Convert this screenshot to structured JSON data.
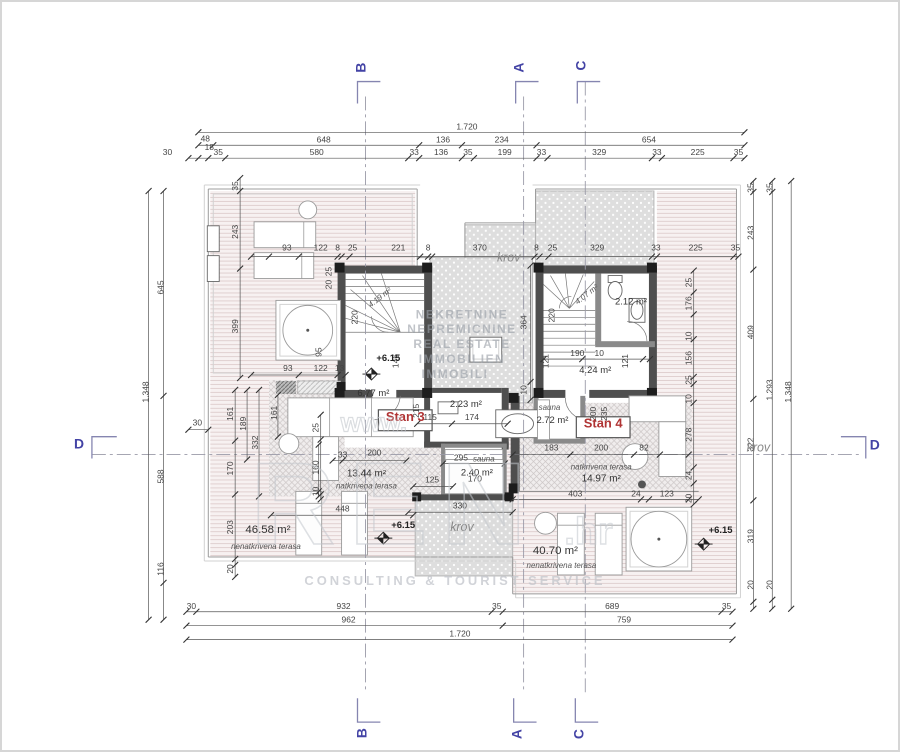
{
  "watermark": {
    "lines": [
      "NEKRETNINE",
      "NEPREMICNINE",
      "REAL ESTATE",
      "IMMOBILIEN",
      "IMMOBILI"
    ],
    "www": "www.",
    "big": "REN",
    "tld": ".hr",
    "tagline": "CONSULTING & TOURIST SERVICE"
  },
  "colors": {
    "section_letter": "#4343a5",
    "stan_label": "#b03434",
    "wall": "#4f4f4f",
    "terrace_stripe_bg": "#f7f1f1",
    "krov_fill": "#dcdcdc"
  },
  "section_markers": [
    {
      "l": "B",
      "x": 365,
      "y": 66,
      "h": 0
    },
    {
      "l": "A",
      "x": 524,
      "y": 66,
      "h": 0
    },
    {
      "l": "C",
      "x": 586,
      "y": 64,
      "h": 0
    },
    {
      "l": "B",
      "x": 366,
      "y": 735,
      "h": 0
    },
    {
      "l": "A",
      "x": 522,
      "y": 736,
      "h": 0
    },
    {
      "l": "C",
      "x": 584,
      "y": 736,
      "h": 0
    },
    {
      "l": "D",
      "x": 77,
      "y": 449,
      "h": 1
    },
    {
      "l": "D",
      "x": 877,
      "y": 450,
      "h": 1
    }
  ],
  "dim_chains": [
    {
      "o": "h",
      "p": 131,
      "a": 197,
      "b": 746,
      "t": [
        197,
        746
      ]
    },
    {
      "o": "h",
      "p": 144,
      "a": 197,
      "b": 746,
      "t": [
        197,
        212,
        419,
        462,
        537,
        746
      ]
    },
    {
      "o": "h",
      "p": 157,
      "a": 187,
      "b": 746,
      "t": [
        187,
        197,
        207,
        224,
        408,
        419,
        462,
        474,
        537,
        548,
        653,
        663,
        735,
        746
      ]
    },
    {
      "o": "h",
      "p": 256,
      "a": 250,
      "b": 740,
      "t": [
        250,
        268,
        298,
        337,
        341,
        349,
        420,
        428,
        432,
        535,
        540,
        549,
        653,
        658,
        735,
        740
      ]
    },
    {
      "o": "h",
      "p": 375,
      "a": 250,
      "b": 345,
      "t": [
        250,
        298,
        337,
        345
      ]
    },
    {
      "o": "h",
      "p": 424,
      "a": 417,
      "b": 508,
      "t": [
        417,
        452,
        508
      ]
    },
    {
      "o": "h",
      "p": 461,
      "a": 332,
      "b": 406,
      "t": [
        332,
        342,
        406
      ]
    },
    {
      "o": "h",
      "p": 464,
      "a": 443,
      "b": 505,
      "t": [
        443,
        505
      ]
    },
    {
      "o": "h",
      "p": 487,
      "a": 413,
      "b": 453,
      "t": [
        413,
        453
      ]
    },
    {
      "o": "h",
      "p": 513,
      "a": 408,
      "b": 513,
      "t": [
        408,
        513
      ]
    },
    {
      "o": "h",
      "p": 516,
      "a": 270,
      "b": 413,
      "t": [
        270,
        413
      ]
    },
    {
      "o": "h",
      "p": 455,
      "a": 513,
      "b": 690,
      "t": [
        513,
        571,
        635,
        661,
        690
      ]
    },
    {
      "o": "h",
      "p": 500,
      "a": 513,
      "b": 700,
      "t": [
        513,
        642,
        650,
        690,
        700
      ]
    },
    {
      "o": "h",
      "p": 359,
      "a": 544,
      "b": 651,
      "t": [
        544,
        583,
        644,
        651
      ]
    },
    {
      "o": "h",
      "p": 613,
      "a": 185,
      "b": 734,
      "t": [
        185,
        195,
        492,
        503,
        723,
        734
      ]
    },
    {
      "o": "h",
      "p": 627,
      "a": 185,
      "b": 734,
      "t": [
        185,
        503,
        734
      ]
    },
    {
      "o": "h",
      "p": 641,
      "a": 185,
      "b": 734,
      "t": [
        185,
        734
      ]
    },
    {
      "o": "h",
      "p": 430,
      "a": 187,
      "b": 207,
      "t": [
        187,
        207
      ]
    },
    {
      "o": "v",
      "p": 147,
      "a": 190,
      "b": 621,
      "t": [
        190,
        621
      ]
    },
    {
      "o": "v",
      "p": 162,
      "a": 190,
      "b": 621,
      "t": [
        190,
        396,
        584,
        621
      ]
    },
    {
      "o": "v",
      "p": 239,
      "a": 177,
      "b": 378,
      "t": [
        177,
        190,
        268,
        378
      ]
    },
    {
      "o": "v",
      "p": 234,
      "a": 390,
      "b": 578,
      "t": [
        390,
        441,
        495,
        560,
        566,
        578
      ]
    },
    {
      "o": "v",
      "p": 246,
      "a": 390,
      "b": 460,
      "t": [
        390,
        460
      ]
    },
    {
      "o": "v",
      "p": 258,
      "a": 390,
      "b": 497,
      "t": [
        390,
        497
      ]
    },
    {
      "o": "v",
      "p": 320,
      "a": 415,
      "b": 500,
      "t": [
        415,
        440,
        495,
        500
      ]
    },
    {
      "o": "v",
      "p": 755,
      "a": 180,
      "b": 610,
      "t": [
        180,
        191,
        269,
        399,
        501,
        603,
        610
      ]
    },
    {
      "o": "v",
      "p": 774,
      "a": 180,
      "b": 610,
      "t": [
        180,
        191,
        601,
        610
      ]
    },
    {
      "o": "v",
      "p": 793,
      "a": 180,
      "b": 610,
      "t": [
        180,
        610
      ]
    },
    {
      "o": "v",
      "p": 531,
      "a": 265,
      "b": 400,
      "t": [
        265,
        382,
        400
      ]
    },
    {
      "o": "v",
      "p": 695,
      "a": 270,
      "b": 505,
      "t": [
        270,
        292,
        314,
        339,
        377,
        384,
        403,
        468,
        484,
        505
      ]
    },
    {
      "o": "v",
      "p": 277,
      "a": 395,
      "b": 437,
      "t": [
        395,
        437
      ]
    },
    {
      "o": "v",
      "p": 318,
      "a": 445,
      "b": 497,
      "t": [
        445,
        492,
        497
      ]
    }
  ],
  "dim_labels": [
    {
      "t": "1.720",
      "x": 467,
      "y": 128
    },
    {
      "t": "48",
      "x": 204,
      "y": 140
    },
    {
      "t": "18",
      "x": 208,
      "y": 149
    },
    {
      "t": "648",
      "x": 323,
      "y": 141
    },
    {
      "t": "136",
      "x": 443,
      "y": 141
    },
    {
      "t": "234",
      "x": 502,
      "y": 141
    },
    {
      "t": "654",
      "x": 650,
      "y": 141
    },
    {
      "t": "30",
      "x": 166,
      "y": 154
    },
    {
      "t": "35",
      "x": 217,
      "y": 154
    },
    {
      "t": "580",
      "x": 316,
      "y": 154
    },
    {
      "t": "33",
      "x": 414,
      "y": 154
    },
    {
      "t": "136",
      "x": 441,
      "y": 154
    },
    {
      "t": "35",
      "x": 468,
      "y": 154
    },
    {
      "t": "199",
      "x": 505,
      "y": 154
    },
    {
      "t": "33",
      "x": 542,
      "y": 154
    },
    {
      "t": "329",
      "x": 600,
      "y": 154
    },
    {
      "t": "33",
      "x": 658,
      "y": 154
    },
    {
      "t": "225",
      "x": 699,
      "y": 154
    },
    {
      "t": "35",
      "x": 740,
      "y": 154
    },
    {
      "t": "1.348",
      "x": 147,
      "y": 392,
      "r": -90
    },
    {
      "t": "645",
      "x": 162,
      "y": 287,
      "r": -90
    },
    {
      "t": "588",
      "x": 162,
      "y": 477,
      "r": -90
    },
    {
      "t": "116",
      "x": 162,
      "y": 570,
      "r": -90
    },
    {
      "t": "30",
      "x": 196,
      "y": 426
    },
    {
      "t": "35",
      "x": 755,
      "y": 187,
      "r": -90
    },
    {
      "t": "243",
      "x": 755,
      "y": 232,
      "r": -90
    },
    {
      "t": "409",
      "x": 755,
      "y": 332,
      "r": -90
    },
    {
      "t": "322",
      "x": 755,
      "y": 445,
      "r": -90
    },
    {
      "t": "319",
      "x": 755,
      "y": 537,
      "r": -90
    },
    {
      "t": "20",
      "x": 755,
      "y": 586,
      "r": -90
    },
    {
      "t": "35",
      "x": 774,
      "y": 187,
      "r": -90
    },
    {
      "t": "1.293",
      "x": 774,
      "y": 390,
      "r": -90
    },
    {
      "t": "20",
      "x": 774,
      "y": 586,
      "r": -90
    },
    {
      "t": "1.348",
      "x": 793,
      "y": 392,
      "r": -90
    },
    {
      "t": "30",
      "x": 190,
      "y": 610
    },
    {
      "t": "932",
      "x": 343,
      "y": 610
    },
    {
      "t": "35",
      "x": 497,
      "y": 610
    },
    {
      "t": "689",
      "x": 613,
      "y": 610
    },
    {
      "t": "35",
      "x": 728,
      "y": 610
    },
    {
      "t": "962",
      "x": 348,
      "y": 624
    },
    {
      "t": "759",
      "x": 625,
      "y": 624
    },
    {
      "t": "1.720",
      "x": 460,
      "y": 638
    },
    {
      "t": "93",
      "x": 286,
      "y": 250
    },
    {
      "t": "122",
      "x": 320,
      "y": 250
    },
    {
      "t": "8",
      "x": 337,
      "y": 250
    },
    {
      "t": "25",
      "x": 352,
      "y": 250
    },
    {
      "t": "221",
      "x": 398,
      "y": 250
    },
    {
      "t": "8",
      "x": 428,
      "y": 250
    },
    {
      "t": "370",
      "x": 480,
      "y": 250
    },
    {
      "t": "8",
      "x": 537,
      "y": 250
    },
    {
      "t": "25",
      "x": 553,
      "y": 250
    },
    {
      "t": "329",
      "x": 598,
      "y": 250
    },
    {
      "t": "33",
      "x": 657,
      "y": 250
    },
    {
      "t": "225",
      "x": 697,
      "y": 250
    },
    {
      "t": "35",
      "x": 737,
      "y": 250
    },
    {
      "t": "93",
      "x": 287,
      "y": 371
    },
    {
      "t": "122",
      "x": 320,
      "y": 371
    },
    {
      "t": "13",
      "x": 339,
      "y": 371
    },
    {
      "t": "35",
      "x": 237,
      "y": 185,
      "r": -90
    },
    {
      "t": "243",
      "x": 237,
      "y": 231,
      "r": -90
    },
    {
      "t": "399",
      "x": 237,
      "y": 326,
      "r": -90
    },
    {
      "t": "25",
      "x": 331,
      "y": 271,
      "r": -90
    },
    {
      "t": "20",
      "x": 331,
      "y": 284,
      "r": -90
    },
    {
      "t": "95",
      "x": 321,
      "y": 352,
      "r": -90
    },
    {
      "t": "161",
      "x": 232,
      "y": 414,
      "r": -90
    },
    {
      "t": "189",
      "x": 245,
      "y": 424,
      "r": -90
    },
    {
      "t": "332",
      "x": 257,
      "y": 443,
      "r": -90
    },
    {
      "t": "170",
      "x": 232,
      "y": 469,
      "r": -90
    },
    {
      "t": "203",
      "x": 232,
      "y": 528,
      "r": -90
    },
    {
      "t": "20",
      "x": 232,
      "y": 570,
      "r": -90
    },
    {
      "t": "161",
      "x": 276,
      "y": 413,
      "r": -90
    },
    {
      "t": "25",
      "x": 318,
      "y": 428,
      "r": -90
    },
    {
      "t": "160",
      "x": 318,
      "y": 468,
      "r": -90
    },
    {
      "t": "10",
      "x": 318,
      "y": 492,
      "r": -90
    },
    {
      "t": "448",
      "x": 342,
      "y": 512
    },
    {
      "t": "33",
      "x": 342,
      "y": 458
    },
    {
      "t": "200",
      "x": 374,
      "y": 456
    },
    {
      "t": "125",
      "x": 432,
      "y": 483
    },
    {
      "t": "330",
      "x": 460,
      "y": 509
    },
    {
      "t": "295",
      "x": 461,
      "y": 461
    },
    {
      "t": "170",
      "x": 475,
      "y": 482
    },
    {
      "t": "115",
      "x": 430,
      "y": 420
    },
    {
      "t": "174",
      "x": 472,
      "y": 420
    },
    {
      "t": "215",
      "x": 419,
      "y": 411,
      "r": -90
    },
    {
      "t": "220",
      "x": 357,
      "y": 317,
      "r": -90
    },
    {
      "t": "146",
      "x": 398,
      "y": 361,
      "r": -90
    },
    {
      "t": "364",
      "x": 527,
      "y": 322,
      "r": -90
    },
    {
      "t": "10",
      "x": 527,
      "y": 390,
      "r": -90
    },
    {
      "t": "220",
      "x": 555,
      "y": 315,
      "r": -90
    },
    {
      "t": "121",
      "x": 549,
      "y": 361,
      "r": -90
    },
    {
      "t": "190",
      "x": 578,
      "y": 356
    },
    {
      "t": "10",
      "x": 600,
      "y": 356
    },
    {
      "t": "121",
      "x": 629,
      "y": 361,
      "r": -90
    },
    {
      "t": "200",
      "x": 597,
      "y": 414,
      "r": -90
    },
    {
      "t": "235",
      "x": 608,
      "y": 414,
      "r": -90
    },
    {
      "t": "25",
      "x": 693,
      "y": 282,
      "r": -90
    },
    {
      "t": "176",
      "x": 693,
      "y": 303,
      "r": -90
    },
    {
      "t": "10",
      "x": 693,
      "y": 336,
      "r": -90
    },
    {
      "t": "156",
      "x": 693,
      "y": 358,
      "r": -90
    },
    {
      "t": "25",
      "x": 693,
      "y": 380,
      "r": -90
    },
    {
      "t": "10",
      "x": 693,
      "y": 399,
      "r": -90
    },
    {
      "t": "278",
      "x": 693,
      "y": 435,
      "r": -90
    },
    {
      "t": "24",
      "x": 693,
      "y": 476,
      "r": -90
    },
    {
      "t": "20",
      "x": 693,
      "y": 499,
      "r": -90
    },
    {
      "t": "183",
      "x": 552,
      "y": 451
    },
    {
      "t": "200",
      "x": 602,
      "y": 451
    },
    {
      "t": "82",
      "x": 645,
      "y": 451
    },
    {
      "t": "403",
      "x": 576,
      "y": 497
    },
    {
      "t": "24",
      "x": 637,
      "y": 497
    },
    {
      "t": "123",
      "x": 668,
      "y": 497
    }
  ],
  "text_labels": [
    {
      "t": "Stan 3",
      "x": 405,
      "y": 421,
      "c": "stan"
    },
    {
      "t": "Stan 4",
      "x": 604,
      "y": 428,
      "c": "stan"
    },
    {
      "t": "6.77 m²",
      "x": 373,
      "y": 396,
      "c": "area"
    },
    {
      "t": "2.23 m²",
      "x": 466,
      "y": 407,
      "c": "area"
    },
    {
      "t": "2.40 m²",
      "x": 477,
      "y": 476,
      "c": "area"
    },
    {
      "t": "2.72 m²",
      "x": 553,
      "y": 423,
      "c": "area"
    },
    {
      "t": "4.24 m²",
      "x": 596,
      "y": 373,
      "c": "area"
    },
    {
      "t": "2.12 m²",
      "x": 632,
      "y": 304,
      "c": "area"
    },
    {
      "t": "4.19 m²",
      "x": 381,
      "y": 299,
      "c": "areasm",
      "r": -38
    },
    {
      "t": "4.07 m²",
      "x": 589,
      "y": 296,
      "c": "areasm",
      "r": -38
    },
    {
      "t": "sauna",
      "x": 484,
      "y": 462,
      "c": "tname"
    },
    {
      "t": "sauna",
      "x": 550,
      "y": 410,
      "c": "tname"
    },
    {
      "t": "13.44 m²",
      "x": 366,
      "y": 477,
      "c": "areamid"
    },
    {
      "t": "natkrivena terasa",
      "x": 366,
      "y": 489,
      "c": "tname"
    },
    {
      "t": "natkrivena terasa",
      "x": 602,
      "y": 470,
      "c": "tname"
    },
    {
      "t": "14.97 m²",
      "x": 602,
      "y": 482,
      "c": "areamid"
    },
    {
      "t": "46.58 m²",
      "x": 267,
      "y": 534,
      "c": "areabig"
    },
    {
      "t": "nenatkrivena terasa",
      "x": 265,
      "y": 550,
      "c": "tname"
    },
    {
      "t": "40.70 m²",
      "x": 556,
      "y": 555,
      "c": "areabig"
    },
    {
      "t": "nenatkrivena terasa",
      "x": 562,
      "y": 569,
      "c": "tname"
    },
    {
      "t": "krov",
      "x": 509,
      "y": 261,
      "c": "krov"
    },
    {
      "t": "krov",
      "x": 462,
      "y": 532,
      "c": "krov"
    },
    {
      "t": "krov",
      "x": 760,
      "y": 452,
      "c": "krov"
    },
    {
      "t": "+6.15",
      "x": 388,
      "y": 361,
      "c": "level"
    },
    {
      "t": "+6.15",
      "x": 403,
      "y": 529,
      "c": "level"
    },
    {
      "t": "+6.15",
      "x": 722,
      "y": 534,
      "c": "level"
    }
  ]
}
